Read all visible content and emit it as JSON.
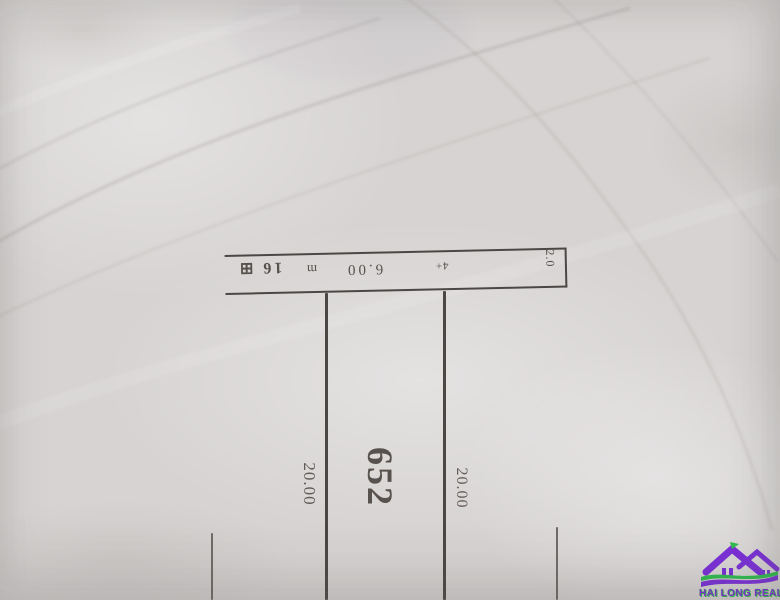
{
  "canvas": {
    "width": 780,
    "height": 600,
    "paper_color": "#d6d3d2",
    "ink_color": "#4b4744"
  },
  "drawing": {
    "parcel_number": "652",
    "dimensions": {
      "left_side": "20.00",
      "right_side": "20.00",
      "frontage": "6.00",
      "strip_width": "2.0"
    },
    "strip_annotations": {
      "adjacent_label": "16 ⊞",
      "survey_mark_a": "m",
      "survey_mark_b": "4+"
    }
  },
  "watermark": {
    "brand": "HAI LONG REAL",
    "purple": "#7a2fd8",
    "green": "#2ebd4e"
  }
}
